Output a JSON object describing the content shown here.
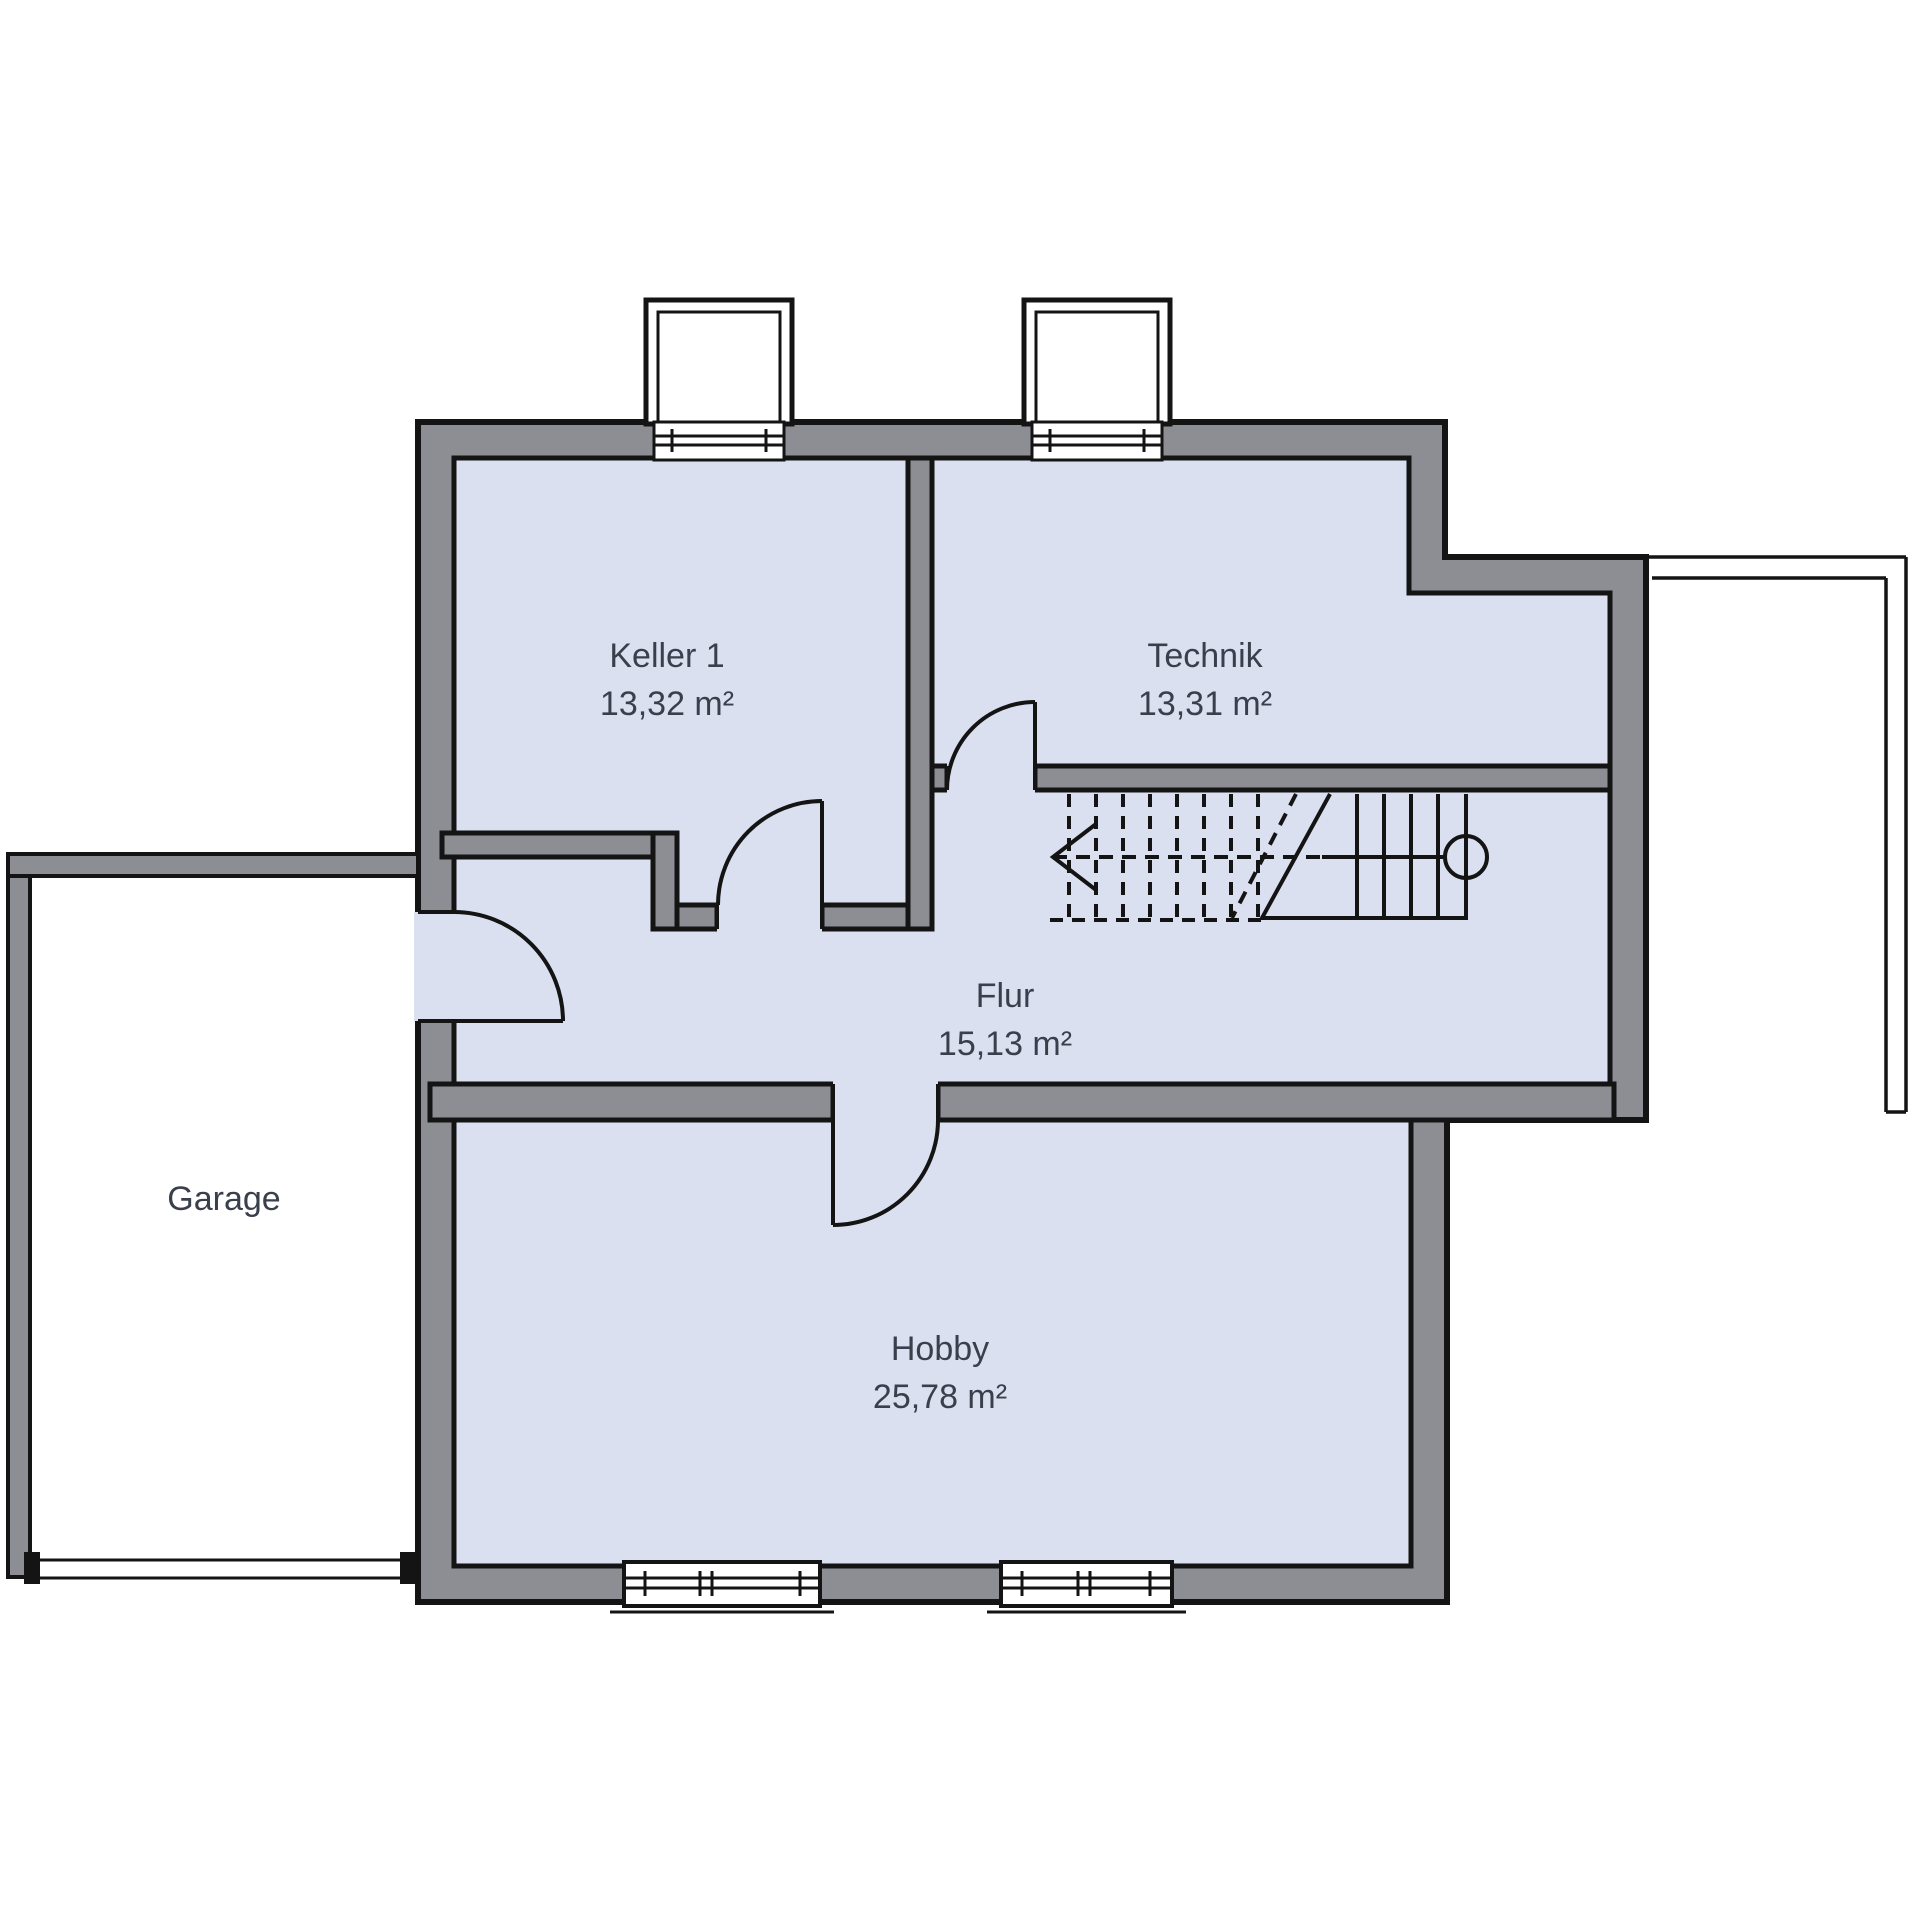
{
  "plan": {
    "title": "Kellergeschoss Grundriss",
    "rooms": [
      {
        "id": "keller1",
        "name": "Keller 1",
        "area": "13,32 m²"
      },
      {
        "id": "technik",
        "name": "Technik",
        "area": "13,31 m²"
      },
      {
        "id": "flur",
        "name": "Flur",
        "area": "15,13 m²"
      },
      {
        "id": "hobby",
        "name": "Hobby",
        "area": "25,78 m²"
      }
    ],
    "garage": {
      "name": "Garage"
    },
    "colors": {
      "wall_fill": "#8c8e94",
      "room_fill": "#dbe0f0",
      "line": "#141414",
      "label": "#3a3f4c",
      "background": "#ffffff"
    },
    "stair": {
      "direction_arrow": "up-to-left"
    }
  }
}
